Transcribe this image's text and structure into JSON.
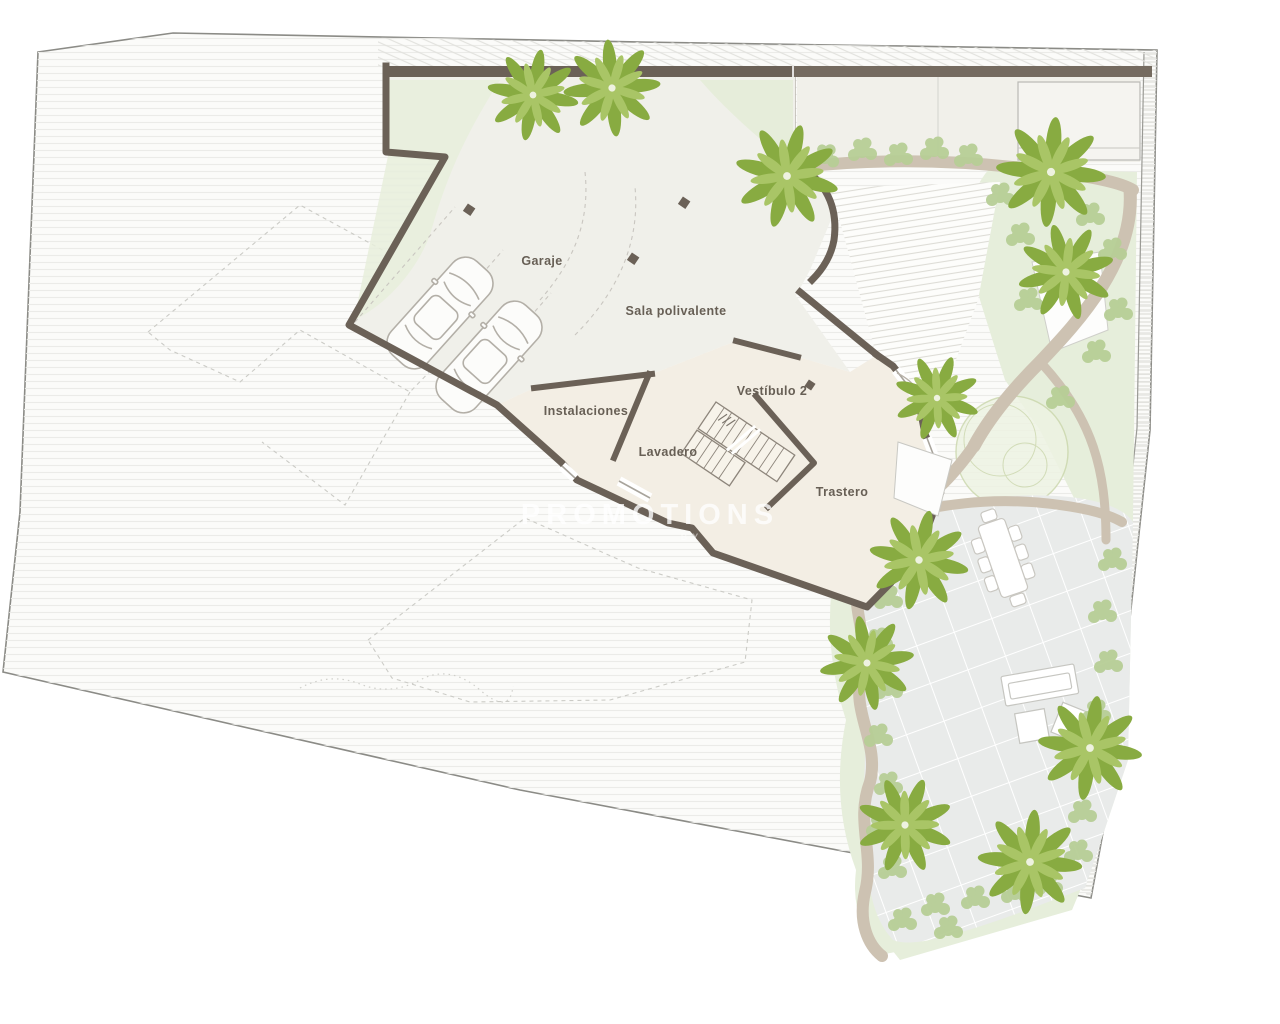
{
  "plan": {
    "type": "architectural-floor-plan",
    "level": "basement",
    "rooms": [
      {
        "id": "garaje",
        "label": "Garaje"
      },
      {
        "id": "sala",
        "label": "Sala polivalente"
      },
      {
        "id": "vestibulo2",
        "label": "Vestíbulo 2"
      },
      {
        "id": "instalaciones",
        "label": "Instalaciones"
      },
      {
        "id": "lavadero",
        "label": "Lavadero"
      },
      {
        "id": "trastero",
        "label": "Trastero"
      }
    ],
    "watermark": {
      "primary": "PROMOTIONS",
      "secondary": "BY"
    },
    "features": [
      "plot-boundary",
      "garage-two-cars",
      "parking-bays",
      "staircase",
      "upper-terrace-hatched",
      "lower-terrace-grid",
      "dining-table-eight-chairs",
      "sun-loungers",
      "palm-trees",
      "shrub-borders",
      "garden-paths",
      "door-swing"
    ],
    "colors": {
      "wall": "#6b6157",
      "wall_light": "#756b60",
      "room_cream": "#f3eee4",
      "garage_fill": "#f0f0ea",
      "sage_green": "#e4ecd8",
      "shrub_green": "#b7ce96",
      "palm_green": "#88ab41",
      "palm_green_light": "#a9c566",
      "path_beige": "#cdc2b2",
      "terrace_fill": "#e9ebea",
      "plot_hatch": "#ebebe8",
      "boundary": "#8b8b86",
      "label_text": "#675f55"
    }
  }
}
